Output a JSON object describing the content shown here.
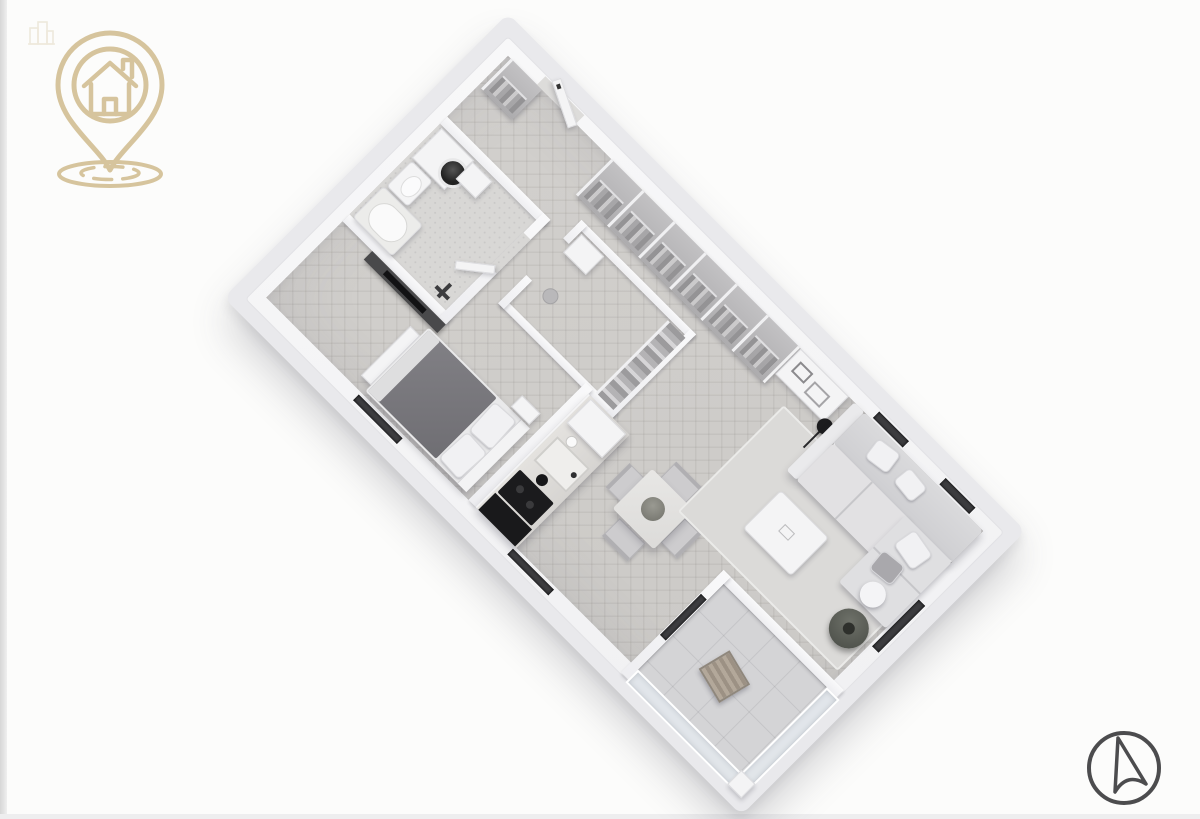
{
  "page": {
    "background": "#fcfcfb",
    "left_edge_color": "#d6d6d6",
    "bottom_edge_color": "#eeeeef"
  },
  "brand_logo": {
    "icon": "house-location-pin-logo",
    "color": "#d4c298",
    "ripples": 2
  },
  "watermark": {
    "icon": "building-watermark-icon",
    "color": "#cbb98e"
  },
  "north_arrow": {
    "icon": "compass-north-arrow",
    "color": "#4c4c4e"
  },
  "floor_plan": {
    "type": "3d-isometric-apartment-render",
    "rotation_deg": 45,
    "palette": {
      "slab": "#e9e9ec",
      "wall": "#f6f6f7",
      "floor_main_herringbone": "#d0cecb",
      "floor_bathroom": "#d8d7d5",
      "floor_balcony": "#d4d4d6",
      "window_glass_dark": "#3d3d40",
      "appliance_black": "#1b1b1d",
      "bed_duvet": "#7b7a7e",
      "sofa_gray": "#dcdbdd",
      "balcony_wood": "#a79d90",
      "plant_green_gray": "#5e615a"
    },
    "rooms": [
      {
        "name": "entry-hall"
      },
      {
        "name": "bathroom"
      },
      {
        "name": "walk-in-closet"
      },
      {
        "name": "bedroom"
      },
      {
        "name": "kitchen"
      },
      {
        "name": "dining-area"
      },
      {
        "name": "living-room"
      },
      {
        "name": "balcony"
      }
    ],
    "wardrobe_cubbies": 6,
    "windows": [
      {
        "name": "window-living-top-1",
        "x": 528,
        "y": 3,
        "w": 42,
        "h": 9
      },
      {
        "name": "window-living-top-2",
        "x": 622,
        "y": 3,
        "w": 42,
        "h": 9
      },
      {
        "name": "window-living-right",
        "x": 689,
        "y": 108,
        "w": 9,
        "h": 66
      },
      {
        "name": "window-bedroom",
        "x": 148,
        "y": 359,
        "w": 62,
        "h": 8
      },
      {
        "name": "window-dining",
        "x": 366,
        "y": 359,
        "w": 58,
        "h": 8
      },
      {
        "name": "balcony-sliding-door",
        "x": 531,
        "y": 258,
        "w": 8,
        "h": 58
      }
    ],
    "furniture": [
      "washing-machine",
      "toilet",
      "bathtub",
      "shower-fixture",
      "tv-panel",
      "double-bed",
      "nightstand",
      "bed-bench",
      "closet-dresser",
      "closet-shelves",
      "kitchen-counter",
      "kitchen-sink",
      "cooktop",
      "oven-cabinet",
      "dining-table",
      "dining-chairs",
      "table-plant",
      "sofa",
      "coffee-table",
      "rug",
      "desk",
      "floor-lamp",
      "floor-plant",
      "balcony-lounge-chair"
    ]
  }
}
